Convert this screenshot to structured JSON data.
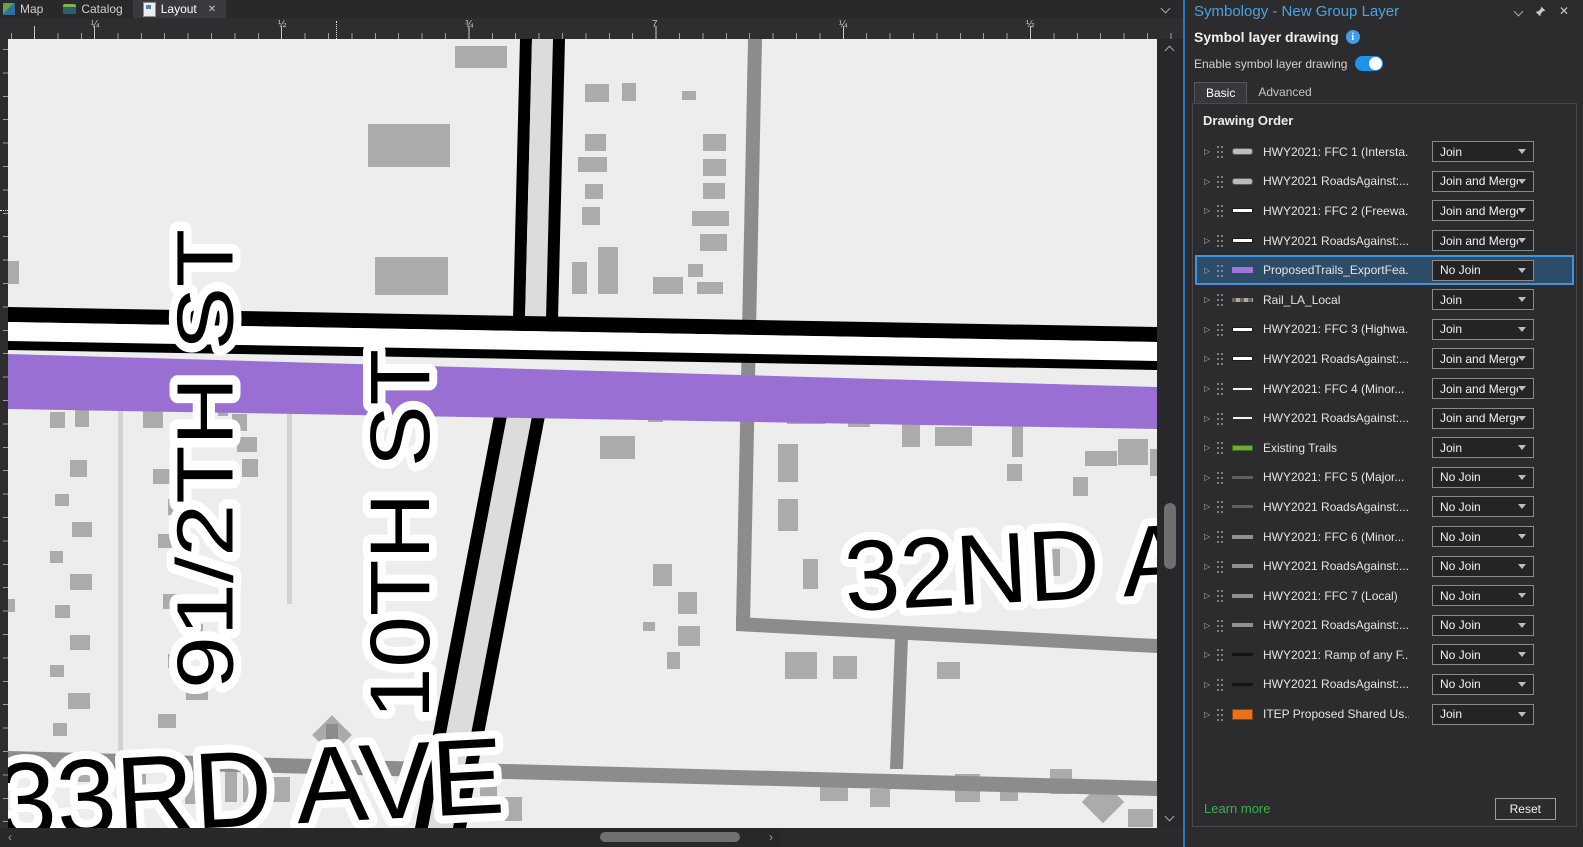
{
  "tab_bar": {
    "map_label": "Map",
    "catalog_label": "Catalog",
    "layout_label": "Layout"
  },
  "ruler": {
    "r1": "¼",
    "r2": "½",
    "r3": "¾",
    "r4": "7",
    "r5": "¼",
    "r6": "½"
  },
  "icons": {
    "close": "✕",
    "scroll_left": "‹",
    "scroll_right": "›"
  },
  "map": {
    "labels": {
      "half_st": "91/2TH ST",
      "tenth_st": "10TH ST",
      "thirty_second": "32ND A",
      "thirty_third": "33RD AVE"
    }
  },
  "panel": {
    "title": "Symbology - New Group Layer",
    "subtitle": "Symbol layer drawing",
    "enable_label": "Enable symbol layer drawing",
    "tabs": {
      "basic": "Basic",
      "advanced": "Advanced"
    },
    "drawing_order_title": "Drawing Order",
    "rows": [
      {
        "label": "HWY2021: FFC 1 (Intersta...",
        "join": "Join"
      },
      {
        "label": "HWY2021 RoadsAgainst:...",
        "join": "Join and Merge"
      },
      {
        "label": "HWY2021: FFC 2 (Freewa...",
        "join": "Join and Merge"
      },
      {
        "label": "HWY2021 RoadsAgainst:...",
        "join": "Join and Merge"
      },
      {
        "label": "ProposedTrails_ExportFea...",
        "join": "No Join"
      },
      {
        "label": "Rail_LA_Local",
        "join": "Join"
      },
      {
        "label": "HWY2021: FFC 3 (Highwa...",
        "join": "Join"
      },
      {
        "label": "HWY2021 RoadsAgainst:...",
        "join": "Join and Merge"
      },
      {
        "label": "HWY2021: FFC 4 (Minor...",
        "join": "Join and Merge"
      },
      {
        "label": "HWY2021 RoadsAgainst:...",
        "join": "Join and Merge"
      },
      {
        "label": "Existing Trails",
        "join": "Join"
      },
      {
        "label": "HWY2021: FFC 5 (Major...",
        "join": "No Join"
      },
      {
        "label": "HWY2021 RoadsAgainst:...",
        "join": "No Join"
      },
      {
        "label": "HWY2021: FFC 6 (Minor...",
        "join": "No Join"
      },
      {
        "label": "HWY2021 RoadsAgainst:...",
        "join": "No Join"
      },
      {
        "label": "HWY2021: FFC 7 (Local)",
        "join": "No Join"
      },
      {
        "label": "HWY2021 RoadsAgainst:...",
        "join": "No Join"
      },
      {
        "label": "HWY2021: Ramp of any F...",
        "join": "No Join"
      },
      {
        "label": "HWY2021 RoadsAgainst:...",
        "join": "No Join"
      },
      {
        "label": "ITEP Proposed Shared Us...",
        "join": "Join"
      }
    ],
    "footer": {
      "learn_more": "Learn more",
      "reset": "Reset"
    }
  },
  "colors": {
    "accent_blue": "#3f94e0",
    "panel_title_blue": "#4aa3e0",
    "proposed_trail_purple": "#9a6fd4",
    "existing_trail_green": "#6fae2f",
    "itep_orange": "#e8711c",
    "learn_more_green": "#3fae49",
    "selected_row_bg": "#2d4c6a",
    "map_background": "#ededed",
    "building_gray": "#ababab"
  }
}
